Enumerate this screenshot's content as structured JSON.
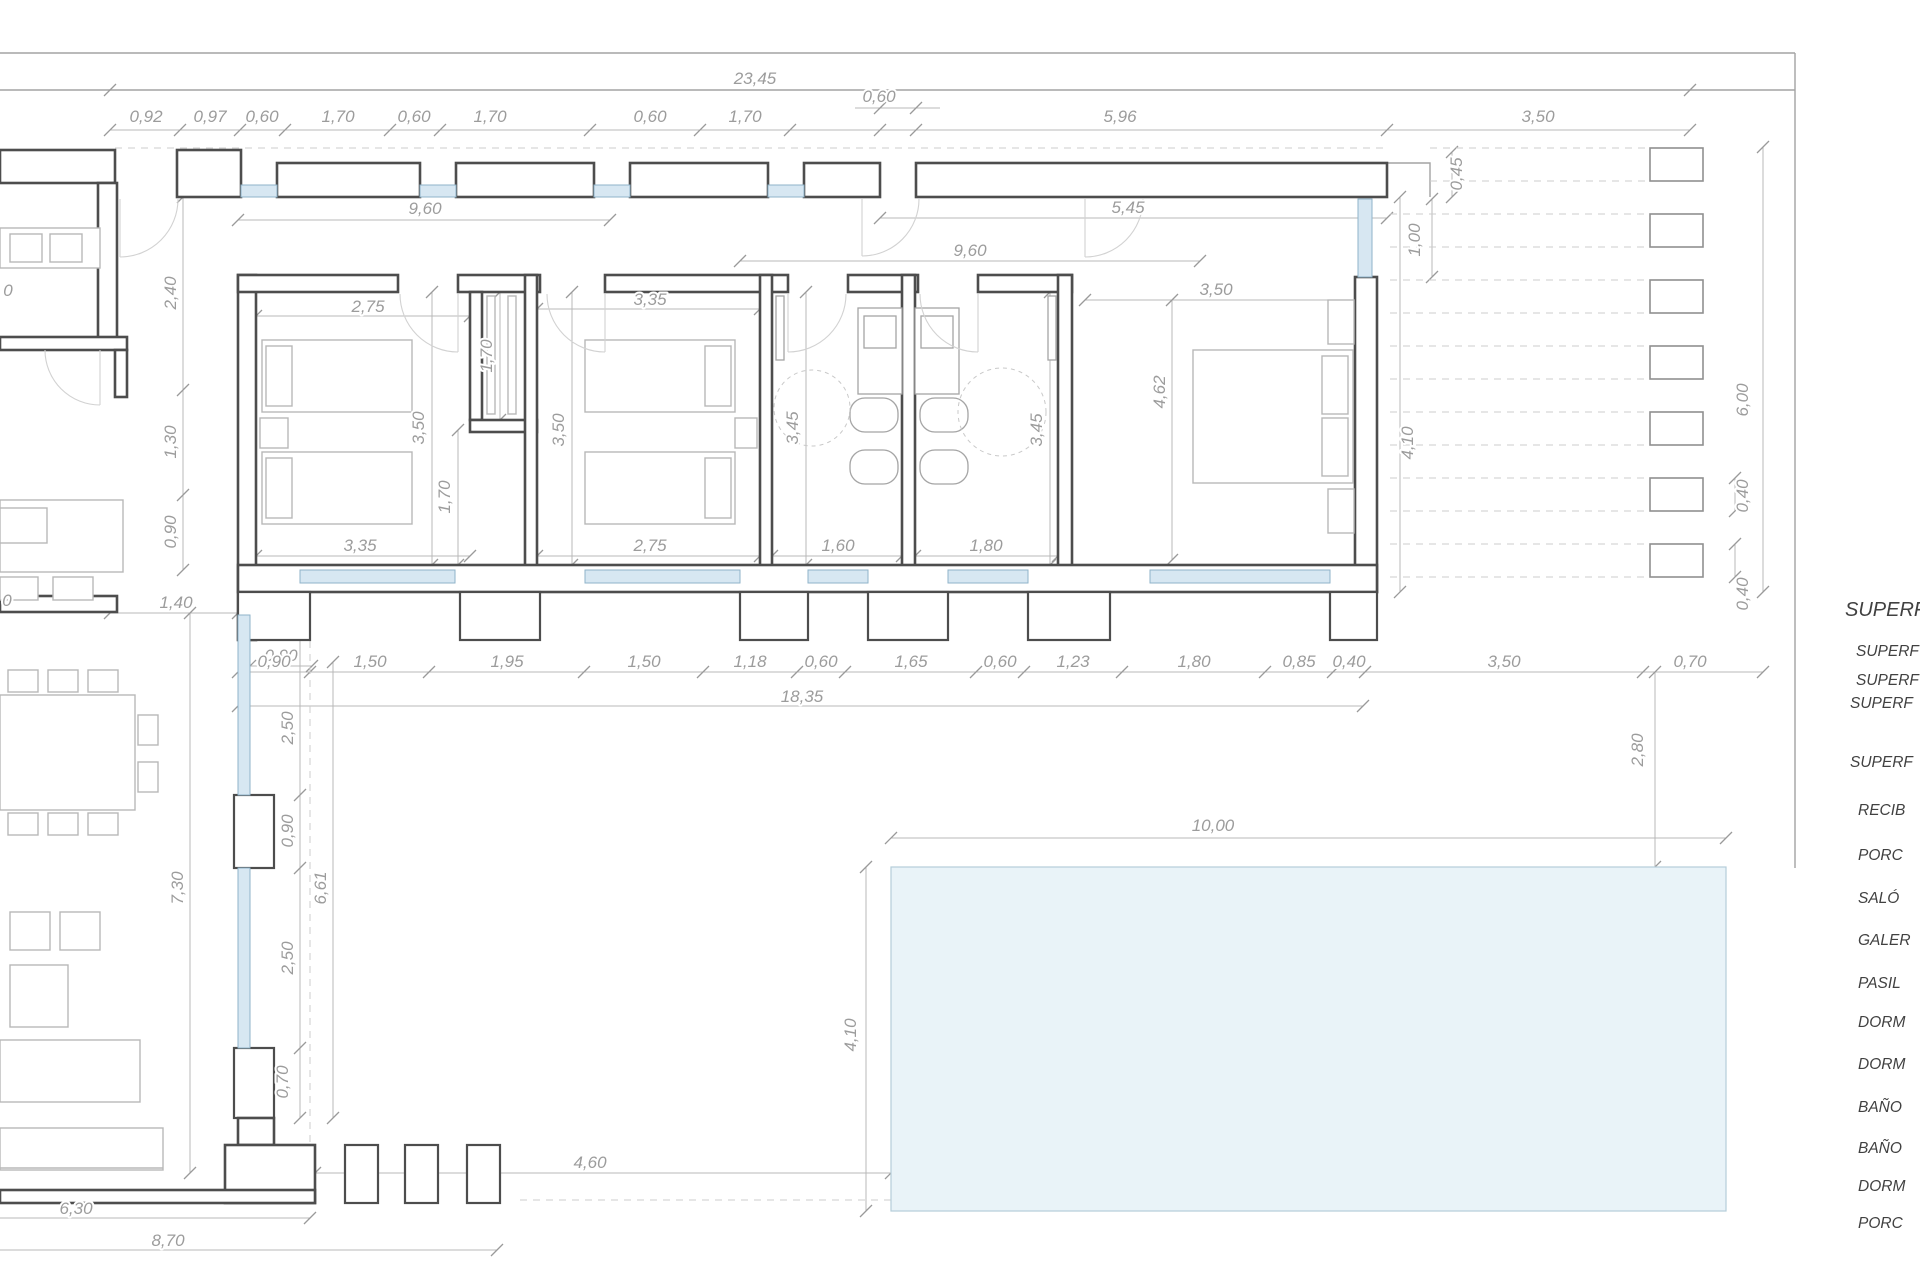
{
  "document_type": "architectural-floor-plan",
  "colors": {
    "wall": "#4d4d4d",
    "dimension_text": "#9c9c9c",
    "window_glass": "#d7e7f2",
    "pool_water": "#e9f3f8",
    "panel_text": "#414141"
  },
  "dims": {
    "total": "23,45",
    "entry_top": "0,60",
    "t1": "0,92",
    "t2": "0,97",
    "t3": "0,60",
    "t4": "1,70",
    "t5": "0,60",
    "t6": "1,70",
    "t7": "0,60",
    "t8": "1,70",
    "t9": "5,96",
    "t10": "3,50",
    "p1": "9,60",
    "p2": "9,60",
    "p3": "5,45",
    "r1": "0,45",
    "r2": "1,00",
    "r3": "3,50",
    "r4": "4,62",
    "r5": "4,10",
    "r6": "6,00",
    "r7": "0,40",
    "r8": "0,40",
    "r9": "2,80",
    "m1": "2,75",
    "m2": "3,35",
    "m3": "3,50",
    "m4": "3,50",
    "m5": "1,70",
    "m6": "1,70",
    "m7": "3,45",
    "m8": "3,45",
    "m9": "3,35",
    "m10": "2,75",
    "m11": "1,60",
    "m12": "1,80",
    "l1": "2,40",
    "l2": "1,30",
    "l3": "0,90",
    "l4": "1,40",
    "l5": "0,90",
    "l6": "2,50",
    "l7": "0,90",
    "l8": "6,61",
    "l9": "2,50",
    "l10": "0,70",
    "l11": "7,30",
    "b1": "6,30",
    "b2": "8,70",
    "c1": "0,90",
    "c2": "1,50",
    "c3": "1,95",
    "c4": "1,50",
    "c5": "1,18",
    "c6": "0,60",
    "c7": "1,65",
    "c8": "0,60",
    "c9": "1,23",
    "c10": "1,80",
    "c11": "0,85",
    "c12": "0,40",
    "c13": "3,50",
    "c14": "0,70",
    "c15": "18,35",
    "q1": "10,00",
    "q2": "4,10",
    "q3": "4,60",
    "f1": "0",
    "f2": "0"
  },
  "panel": {
    "header": "SUPERF",
    "lines": [
      "SUPERF",
      "SUPERF",
      "SUPERF",
      "SUPERF",
      "RECIB",
      "PORC",
      "SALÓ",
      "GALER",
      "PASIL",
      "DORM",
      "DORM",
      "BAÑO",
      "BAÑO",
      "DORM",
      "PORC"
    ]
  }
}
